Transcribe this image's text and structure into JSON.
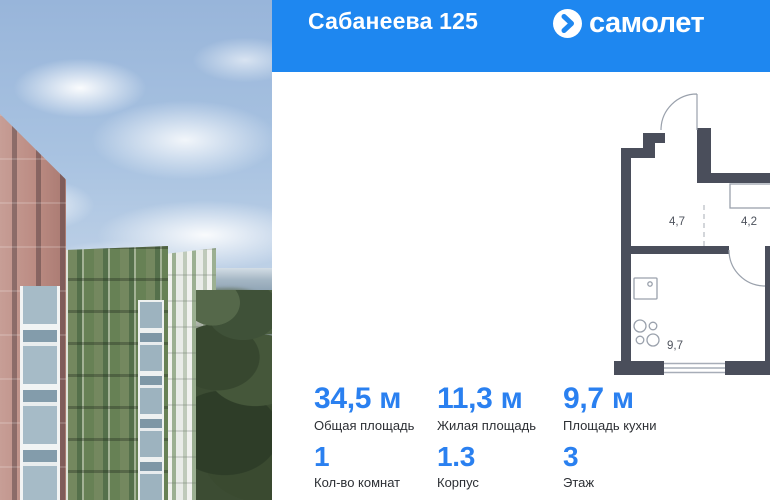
{
  "header": {
    "title": "Сабанеева 125",
    "brand": "самолет"
  },
  "plan": {
    "rooms": [
      {
        "name": "hallway",
        "label": "4,7"
      },
      {
        "name": "corridor",
        "label": "4,2"
      },
      {
        "name": "bathroom",
        "label": "4,6"
      },
      {
        "name": "kitchen",
        "label": "9,7"
      },
      {
        "name": "living-room",
        "label": "11,3"
      }
    ]
  },
  "stats": {
    "primary": [
      {
        "value": "34,5 м",
        "label": "Общая площадь"
      },
      {
        "value": "11,3 м",
        "label": "Жилая площадь"
      },
      {
        "value": "9,7 м",
        "label": "Площадь кухни"
      }
    ],
    "secondary": [
      {
        "value": "1",
        "label": "Кол-во комнат"
      },
      {
        "value": "1.3",
        "label": "Корпус"
      },
      {
        "value": "3",
        "label": "Этаж"
      }
    ]
  },
  "colors": {
    "header_blue": "#1e87f0",
    "value_blue": "#2a80f0",
    "wall_dark": "#4a4e5b"
  }
}
